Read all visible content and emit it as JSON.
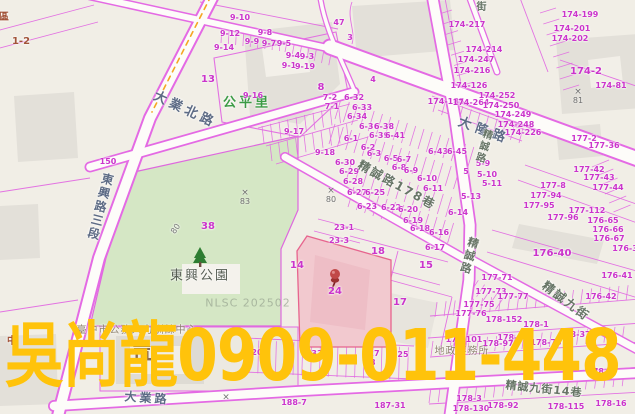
{
  "map": {
    "ad_overlay": {
      "text": "吳尚龍0909-011-448",
      "color": "#ffc30b"
    },
    "watermark": {
      "text": "NLSC 202502"
    },
    "park": {
      "name": "東興公園"
    },
    "village": {
      "name": "公平里"
    },
    "institution": {
      "name": "臺中市公務人力訓練中心"
    },
    "office": {
      "name": "地政事務所"
    },
    "colors": {
      "parcel_line": "#e26ce2",
      "parcel_number": "#cb34cb",
      "park_fill": "#d5e7c5",
      "highlight_parcel_fill": "#f2c9cf",
      "ad_yellow": "#ffc30b"
    },
    "roads": [
      {
        "name": "東興路三段"
      },
      {
        "name": "大業北路"
      },
      {
        "name": "大隆路"
      },
      {
        "name": "精誠路"
      },
      {
        "name": "精誠路178巷"
      },
      {
        "name": "精誠九街"
      },
      {
        "name": "精誠九街14巷"
      },
      {
        "name": "大業路"
      },
      {
        "name": "街"
      }
    ],
    "markers": [
      {
        "t": "83",
        "x": 245,
        "y": 198
      },
      {
        "t": "80",
        "x": 331,
        "y": 196
      },
      {
        "t": "81",
        "x": 578,
        "y": 97
      },
      {
        "t": "",
        "x": 226,
        "y": 398
      }
    ],
    "parcels": [
      {
        "t": "9-10",
        "x": 240,
        "y": 18
      },
      {
        "t": "9-12",
        "x": 230,
        "y": 34
      },
      {
        "t": "9-14",
        "x": 224,
        "y": 48
      },
      {
        "t": "9-8",
        "x": 265,
        "y": 33
      },
      {
        "t": "9-9",
        "x": 252,
        "y": 42
      },
      {
        "t": "9-7",
        "x": 269,
        "y": 44
      },
      {
        "t": "9-5",
        "x": 284,
        "y": 44
      },
      {
        "t": "9-4",
        "x": 293,
        "y": 56
      },
      {
        "t": "9-3",
        "x": 307,
        "y": 57
      },
      {
        "t": "9-1",
        "x": 289,
        "y": 66
      },
      {
        "t": "9-19",
        "x": 305,
        "y": 67
      },
      {
        "t": "9-16",
        "x": 253,
        "y": 96
      },
      {
        "t": "13",
        "x": 208,
        "y": 80,
        "s": 1
      },
      {
        "t": "8",
        "x": 321,
        "y": 88,
        "s": 1
      },
      {
        "t": "7-2",
        "x": 330,
        "y": 98
      },
      {
        "t": "7-1",
        "x": 332,
        "y": 107
      },
      {
        "t": "9-17",
        "x": 294,
        "y": 132
      },
      {
        "t": "9-18",
        "x": 325,
        "y": 153
      },
      {
        "t": "150",
        "x": 108,
        "y": 162
      },
      {
        "t": "47",
        "x": 339,
        "y": 23
      },
      {
        "t": "3",
        "x": 350,
        "y": 38
      },
      {
        "t": "4",
        "x": 373,
        "y": 80
      },
      {
        "t": "1-2",
        "x": 21,
        "y": 42,
        "c": "brown"
      },
      {
        "t": "區",
        "x": 4,
        "y": 18,
        "c": "brown"
      },
      {
        "t": "中",
        "x": 12,
        "y": 342,
        "c": "brown"
      },
      {
        "t": "174-217",
        "x": 467,
        "y": 25
      },
      {
        "t": "174-214",
        "x": 484,
        "y": 50
      },
      {
        "t": "174-247",
        "x": 476,
        "y": 60
      },
      {
        "t": "174-216",
        "x": 472,
        "y": 71
      },
      {
        "t": "174-126",
        "x": 469,
        "y": 86
      },
      {
        "t": "174-199",
        "x": 580,
        "y": 15
      },
      {
        "t": "174-201",
        "x": 572,
        "y": 29
      },
      {
        "t": "174-202",
        "x": 570,
        "y": 39
      },
      {
        "t": "174-2",
        "x": 586,
        "y": 72,
        "s": 1
      },
      {
        "t": "174-81",
        "x": 611,
        "y": 86
      },
      {
        "t": "174-185",
        "x": 446,
        "y": 102
      },
      {
        "t": "174-264",
        "x": 471,
        "y": 103
      },
      {
        "t": "174-252",
        "x": 497,
        "y": 96
      },
      {
        "t": "174-250",
        "x": 501,
        "y": 106
      },
      {
        "t": "174-249",
        "x": 513,
        "y": 115
      },
      {
        "t": "174-248",
        "x": 516,
        "y": 125
      },
      {
        "t": "174-226",
        "x": 523,
        "y": 133
      },
      {
        "t": "177-2",
        "x": 584,
        "y": 139
      },
      {
        "t": "177-36",
        "x": 604,
        "y": 146
      },
      {
        "t": "177-42",
        "x": 589,
        "y": 170
      },
      {
        "t": "177-43",
        "x": 599,
        "y": 178
      },
      {
        "t": "177-44",
        "x": 608,
        "y": 188
      },
      {
        "t": "177-8",
        "x": 553,
        "y": 186
      },
      {
        "t": "177-94",
        "x": 546,
        "y": 196
      },
      {
        "t": "177-95",
        "x": 539,
        "y": 206
      },
      {
        "t": "177-112",
        "x": 587,
        "y": 211
      },
      {
        "t": "177-96",
        "x": 563,
        "y": 218
      },
      {
        "t": "176-65",
        "x": 603,
        "y": 221
      },
      {
        "t": "176-66",
        "x": 608,
        "y": 230
      },
      {
        "t": "176-67",
        "x": 609,
        "y": 239
      },
      {
        "t": "176-3",
        "x": 625,
        "y": 249
      },
      {
        "t": "176-40",
        "x": 552,
        "y": 254,
        "s": 1
      },
      {
        "t": "176-41",
        "x": 617,
        "y": 276
      },
      {
        "t": "176-42",
        "x": 601,
        "y": 297
      },
      {
        "t": "177-71",
        "x": 497,
        "y": 278
      },
      {
        "t": "177-73",
        "x": 491,
        "y": 292
      },
      {
        "t": "177-77",
        "x": 513,
        "y": 297
      },
      {
        "t": "177-75",
        "x": 479,
        "y": 305
      },
      {
        "t": "177-76",
        "x": 471,
        "y": 314
      },
      {
        "t": "6-32",
        "x": 354,
        "y": 98
      },
      {
        "t": "6-33",
        "x": 362,
        "y": 108
      },
      {
        "t": "6-34",
        "x": 357,
        "y": 117
      },
      {
        "t": "6-36",
        "x": 369,
        "y": 127
      },
      {
        "t": "6-38",
        "x": 384,
        "y": 127
      },
      {
        "t": "6-39",
        "x": 379,
        "y": 136
      },
      {
        "t": "6-41",
        "x": 395,
        "y": 136
      },
      {
        "t": "6-43",
        "x": 438,
        "y": 152
      },
      {
        "t": "6-45",
        "x": 457,
        "y": 152
      },
      {
        "t": "6-1",
        "x": 351,
        "y": 139
      },
      {
        "t": "6-2",
        "x": 368,
        "y": 148
      },
      {
        "t": "6-3",
        "x": 374,
        "y": 154
      },
      {
        "t": "6-5",
        "x": 391,
        "y": 159
      },
      {
        "t": "6-7",
        "x": 404,
        "y": 160
      },
      {
        "t": "6-8",
        "x": 399,
        "y": 168
      },
      {
        "t": "6-9",
        "x": 411,
        "y": 171
      },
      {
        "t": "6-30",
        "x": 345,
        "y": 163
      },
      {
        "t": "6-29",
        "x": 349,
        "y": 172
      },
      {
        "t": "6-28",
        "x": 353,
        "y": 182
      },
      {
        "t": "6-27",
        "x": 357,
        "y": 193
      },
      {
        "t": "6-25",
        "x": 375,
        "y": 193
      },
      {
        "t": "6-23",
        "x": 367,
        "y": 207
      },
      {
        "t": "6-22",
        "x": 391,
        "y": 208
      },
      {
        "t": "6-20",
        "x": 408,
        "y": 210
      },
      {
        "t": "6-19",
        "x": 413,
        "y": 221
      },
      {
        "t": "6-18",
        "x": 420,
        "y": 229
      },
      {
        "t": "6-16",
        "x": 439,
        "y": 233
      },
      {
        "t": "6-17",
        "x": 435,
        "y": 248
      },
      {
        "t": "6-14",
        "x": 458,
        "y": 213
      },
      {
        "t": "6-10",
        "x": 427,
        "y": 179
      },
      {
        "t": "6-11",
        "x": 433,
        "y": 189
      },
      {
        "t": "5-9",
        "x": 483,
        "y": 164
      },
      {
        "t": "5",
        "x": 466,
        "y": 172
      },
      {
        "t": "5-10",
        "x": 487,
        "y": 175
      },
      {
        "t": "5-11",
        "x": 492,
        "y": 184
      },
      {
        "t": "5-13",
        "x": 471,
        "y": 197
      },
      {
        "t": "18",
        "x": 378,
        "y": 252,
        "s": 1
      },
      {
        "t": "15",
        "x": 426,
        "y": 266,
        "s": 1
      },
      {
        "t": "17",
        "x": 400,
        "y": 303,
        "s": 1
      },
      {
        "t": "24",
        "x": 335,
        "y": 292,
        "s": 1
      },
      {
        "t": "23-1",
        "x": 344,
        "y": 228
      },
      {
        "t": "23-3",
        "x": 339,
        "y": 241
      },
      {
        "t": "14",
        "x": 297,
        "y": 266,
        "s": 1
      },
      {
        "t": "38",
        "x": 208,
        "y": 227,
        "s": 1
      },
      {
        "t": "80",
        "x": 176,
        "y": 229,
        "c": "grey",
        "r": -55
      },
      {
        "t": "20",
        "x": 257,
        "y": 353
      },
      {
        "t": "33",
        "x": 317,
        "y": 354
      },
      {
        "t": "27",
        "x": 374,
        "y": 354
      },
      {
        "t": "28",
        "x": 370,
        "y": 363
      },
      {
        "t": "25",
        "x": 403,
        "y": 355
      },
      {
        "t": "178-152",
        "x": 504,
        "y": 320
      },
      {
        "t": "178-1",
        "x": 536,
        "y": 325
      },
      {
        "t": "178-37",
        "x": 575,
        "y": 335
      },
      {
        "t": "178-101",
        "x": 464,
        "y": 340
      },
      {
        "t": "178-96",
        "x": 513,
        "y": 338
      },
      {
        "t": "178-97",
        "x": 498,
        "y": 344
      },
      {
        "t": "178-73",
        "x": 546,
        "y": 343
      },
      {
        "t": "178-4",
        "x": 600,
        "y": 372
      },
      {
        "t": "178-3",
        "x": 469,
        "y": 399
      },
      {
        "t": "178-130",
        "x": 471,
        "y": 409
      },
      {
        "t": "178-92",
        "x": 503,
        "y": 406
      },
      {
        "t": "178-115",
        "x": 566,
        "y": 407
      },
      {
        "t": "178-16",
        "x": 611,
        "y": 404
      },
      {
        "t": "187-31",
        "x": 390,
        "y": 406
      },
      {
        "t": "188-7",
        "x": 294,
        "y": 403
      }
    ]
  }
}
